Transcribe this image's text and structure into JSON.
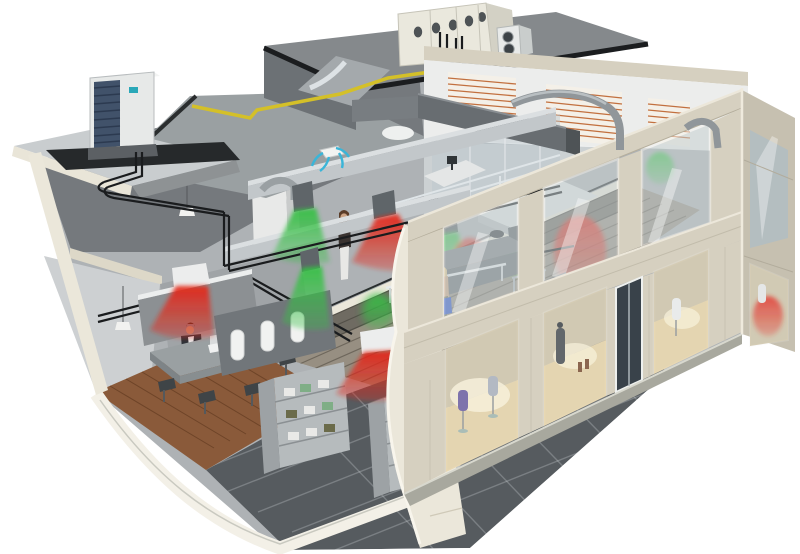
{
  "meta": {
    "description": "3D isometric cutaway illustration of a two-story commercial building showing a complete HVAC / VRV air-conditioning installation: rooftop air handling unit and condenser units, grey supply ductwork, black refrigerant piping, yellow roof piping, ceiling cassettes and duct outlets blowing green (cool) and red (warm) airflow cones; ground-floor retail shop with shelving, mannequins and shoppers; mezzanine office with desks; beige stone facade with display windows.",
    "image_type": "architectural cutaway rendering",
    "width": 800,
    "height": 554,
    "visible_text": "none"
  },
  "palette": {
    "cone_green": "#35c044",
    "cone_red": "#e42718",
    "arrow_blue": "#3ab5d8",
    "pipe_yellow": "#d4c028",
    "pipe_black": "#1a1c1e",
    "facade_beige": "#d6d0c0",
    "facade_side": "#c6c0b0",
    "cream_edge": "#ebe7da",
    "roof_gray": "#9aa0a2",
    "deck_dark": "#6c7175",
    "duct_gray": "#c2c7ca",
    "duct_dark": "#686d71",
    "glass": "#c6d0d2",
    "louver_orange": "#c2703f",
    "tile_floor": "#565b5f",
    "wood_floor": "#8a5a3a",
    "mezzanine_deck": "#978f82",
    "unit_white": "#e8eae9",
    "grille_blue": "#41526a",
    "dress_purple": "#6a5aa0",
    "shopper_pink": "#d6358a",
    "bag_blue": "#2b52c8",
    "background": "#ffffff"
  },
  "scene": {
    "building": {
      "floors": 2,
      "ground_floor": "retail shop: tiled floor, two gondola shelving units with boxes, white display torsos, clothing racks, shoppers, meeting room with table and seated man, display windows with dress forms and boots, glass entrance door",
      "upper_floor": "mezzanine office: slatted deck, desks with monitors, office chairs, glass partitions, standing woman",
      "roof": "grey roof deck with raised plant deck, parapet, louvered clerestory wall"
    },
    "hvac": {
      "rooftop_ahu": "large cream air-handling unit with oval vent holes and pipe loops",
      "outdoor_units": [
        "white VRV condenser with blue side grille on left roof ledge",
        "small twin-fan condenser beside the AHU"
      ],
      "ducts": "light grey rectangular supply ducts across both ceilings, large dark grey main duct, round duct elbows over the facade beam, sloped duct ramp from roof",
      "piping": "black refrigerant pipe runs along walls and ceilings, yellow pipe run on the roof deck",
      "indoor_units": "white ceiling cassettes and dark duct outlet boxes",
      "airflow_cones": {
        "green_cool": 7,
        "red_warm": 6,
        "blue_cassette_arrows": 4
      }
    },
    "people": [
      "man seated at meeting table",
      "woman standing on mezzanine",
      "shopper in pink top",
      "blonde shopper with blue bag"
    ],
    "mannequins": [
      "three white torsos in shop",
      "striped-dress mannequin",
      "purple-dress form in window",
      "grey-dress form in window",
      "dark figure with boots in window",
      "white forms in corner windows"
    ]
  }
}
